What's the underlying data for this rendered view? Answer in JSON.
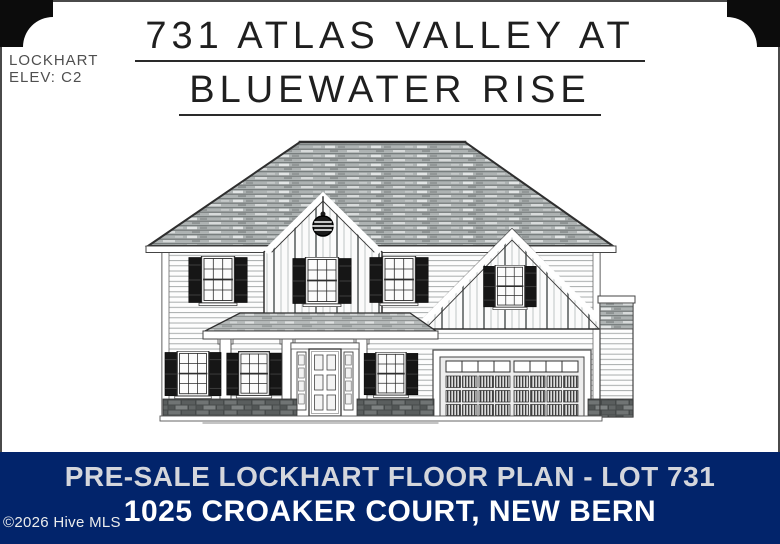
{
  "sheet": {
    "plan_name": "LOCKHART",
    "elevation": "ELEV: C2",
    "title_line1": "731 ATLAS VALLEY AT",
    "title_line2": "BLUEWATER RISE"
  },
  "drawing": {
    "type": "front-elevation",
    "subject": "Two-story house rendering: hip shingle roof, center gable with round vent, right garage gable, covered entry porch, shuttered windows, two-car garage door, stone skirt, side chimney",
    "paper_color": "#ffffff",
    "line_color": "#3a3a3a",
    "roof_color": "#aeb3b3"
  },
  "banner": {
    "line1": "PRE-SALE LOCKHART FLOOR PLAN - LOT 731",
    "line2": "1025 CROAKER COURT, NEW BERN",
    "watermark": "©2026 Hive MLS",
    "background_color": "#02246b",
    "line1_color": "#d4d6dc",
    "line2_color": "#ffffff"
  }
}
